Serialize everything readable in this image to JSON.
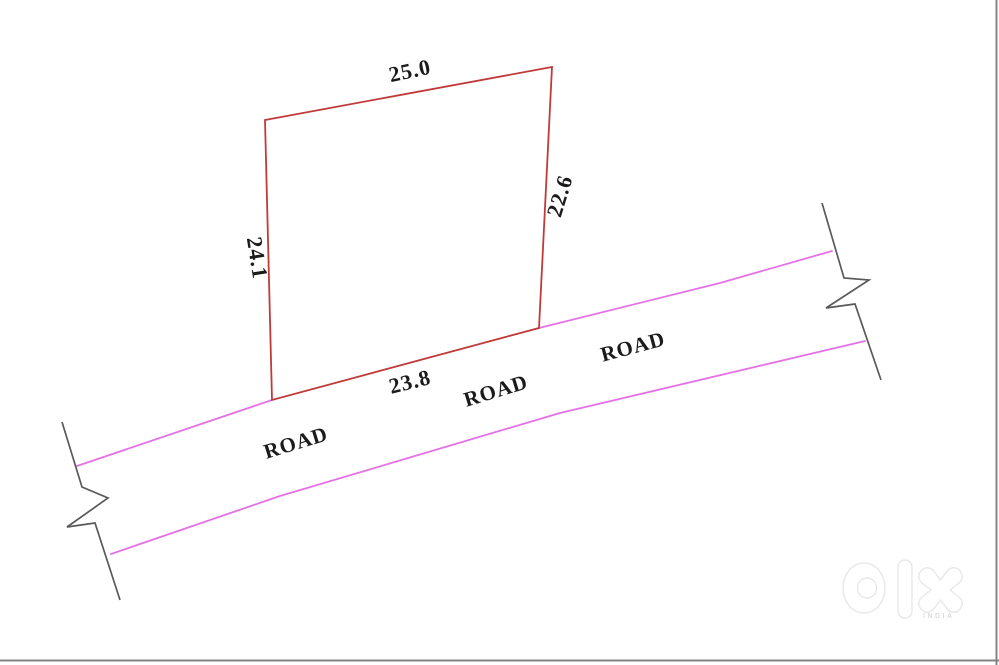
{
  "diagram": {
    "plot": {
      "outline_color": "#c13a3a",
      "dimensions": {
        "top": "25.0",
        "right": "22.6",
        "bottom": "23.8",
        "left": "24.1"
      }
    },
    "road": {
      "line_color": "#e472e4",
      "break_color": "#5a5a5a",
      "labels": [
        "ROAD",
        "ROAD",
        "ROAD"
      ]
    },
    "frame": {
      "border_color": "#848484"
    }
  },
  "watermark": {
    "brand": "olx",
    "subtext": "INDIA",
    "color": "#e8e8e8"
  }
}
